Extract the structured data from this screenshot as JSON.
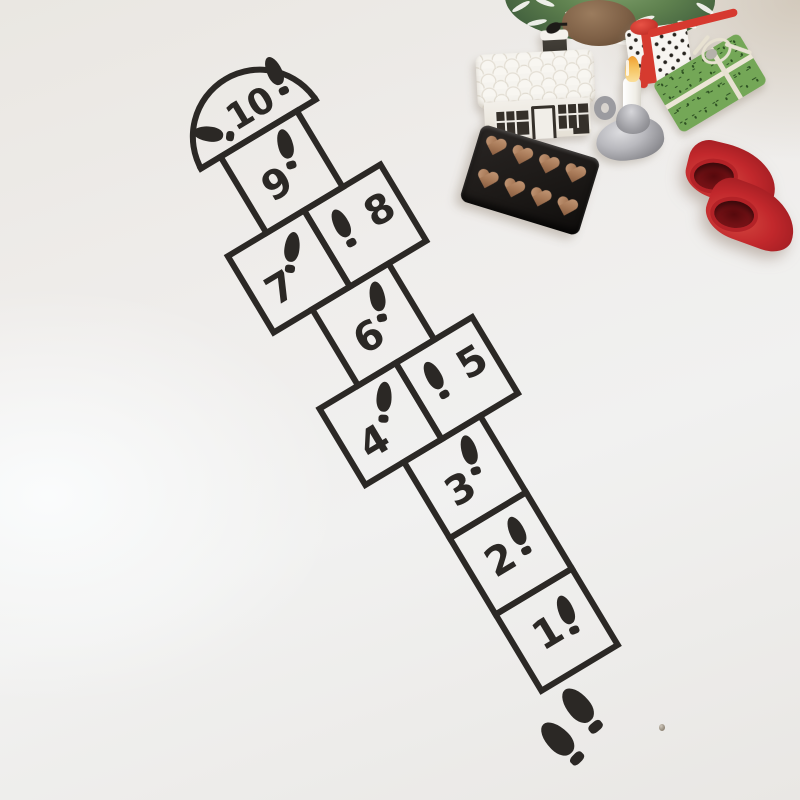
{
  "background": {
    "floor_color": "#edebe8",
    "corner_shade_color": "#cbbda7",
    "highlight_color": "#fbfdff"
  },
  "hopscotch": {
    "stencil_color": "#2b2825",
    "cells": [
      {
        "number": "1"
      },
      {
        "number": "2"
      },
      {
        "number": "3"
      },
      {
        "number": "4"
      },
      {
        "number": "5"
      },
      {
        "number": "6"
      },
      {
        "number": "7"
      },
      {
        "number": "8"
      },
      {
        "number": "9"
      },
      {
        "number": "10"
      }
    ],
    "footprints_per_cell": 1,
    "dome_footprints": 2,
    "start_footprints": 2
  },
  "decorations": {
    "tree": {
      "foliage_color": "#55764a",
      "flock_color": "#fbfaf6",
      "base_color": "#7e6046"
    },
    "house": {
      "body_color": "#f2efe9",
      "trim_color": "#35302a"
    },
    "polka_gift": {
      "box_color": "#f7f5f1",
      "dot_color": "#27241f",
      "ribbon_color": "#d6392f"
    },
    "green_gift": {
      "paper_color": "#74a757",
      "pattern_color": "#2d5022",
      "twine_color": "#e7e1d1"
    },
    "candle": {
      "wax_color": "#f4f2ec",
      "tip_color": "#f0a83a",
      "holder_color": "#a8a8ac"
    },
    "chocolate_tray": {
      "tray_color": "#1b1816",
      "heart_color": "#a87a58",
      "heart_count": 8
    },
    "clogs": {
      "color": "#c2282c",
      "count": 2
    }
  }
}
